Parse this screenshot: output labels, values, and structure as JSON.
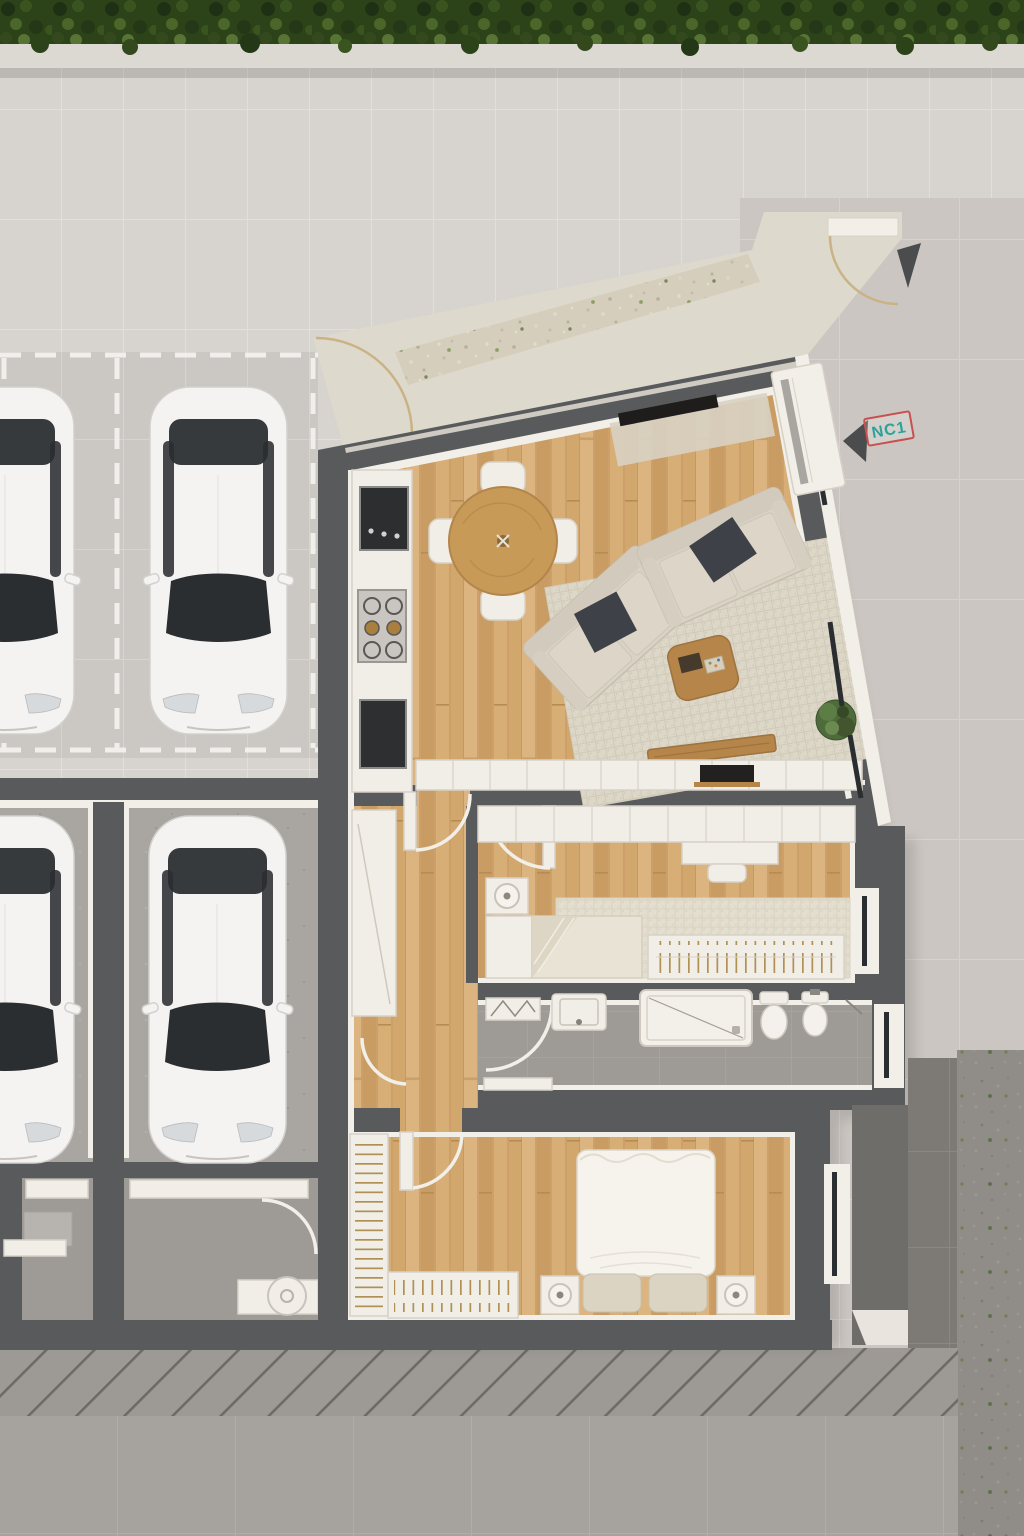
{
  "labels": {
    "unit_badge": "NC1"
  },
  "colors": {
    "wall_dark": "#595a5c",
    "lining_white": "#f2efe9",
    "furniture_white": "#f1eee8",
    "furniture_stroke": "#d8d2c8",
    "glass_dark": "#2b2e31",
    "wood_light": "#dcb480",
    "wood_mid": "#d2a76e",
    "wood_dark": "#c89c62",
    "wood_seam": "#b98f55",
    "pavement_upper": "#d7d3ce",
    "pavement_grout": "#e2dfda",
    "parking_floor": "#cbc7c2",
    "pavement_right": "#cbc6c1",
    "pavement_lower": "#a6a29e",
    "speckled_dark": "#908d88",
    "terrace_cream": "#ded9cd",
    "gravel_beige": "#d5cebc",
    "hedge_green": "#2c4219",
    "planter_grey": "#dcd8d2",
    "concrete_floor": "#a9a5a1",
    "bath_floor": "#9e9b96",
    "rug_beige": "#ddd7c8",
    "rug_light": "#e4decf",
    "sofa_beige": "#d9d2c5",
    "pillow_charcoal": "#3e4248",
    "coffee_wood": "#b5854a",
    "car_body": "#f4f3f1",
    "arrow_dark": "#4b4c4e",
    "nc1_teal": "#2ba39a",
    "nc1_red": "#c85050",
    "gate_gold": "#c9b384",
    "hatch_base": "#9d9995",
    "hatch_line": "#6e6a66",
    "dark_tiles": "#7d7a76",
    "parapet_grey": "#6f6d6a"
  },
  "site": {
    "type": "top-down 3D architectural floor plan render",
    "areas": [
      "hedge planter strip",
      "tiled walkway",
      "open parking spaces",
      "garage boxes",
      "utility rooms",
      "hatched access ramp",
      "apartment NC1",
      "gravel terrace path",
      "side terrace"
    ],
    "parking": {
      "open_spaces": 2,
      "garage_boxes": 2,
      "white_cars_visible": 4,
      "marking_style": "white dashed lines"
    },
    "landscape": {
      "hedge_strip": true,
      "gravel_path": true,
      "gate_swing_arcs": 2,
      "direction_arrows": 2,
      "access_ramp_hatched": true
    }
  },
  "apartment": {
    "unit": "NC1",
    "entrance": "glazed entry door at the top-right corner",
    "windows_right_wall": 3,
    "rooms": [
      {
        "name": "living room + kitchen",
        "floor": "light wood planks",
        "items": [
          "kitchen counter",
          "dark sink module",
          "cooktop with six burners",
          "dark appliance module",
          "round dining table",
          "4 dining chairs",
          "two beige sofas",
          "2 charcoal throw pillows",
          "wooden coffee table",
          "wooden bench",
          "large area rug",
          "tv on console mat",
          "white sideboard",
          "potted plant"
        ]
      },
      {
        "name": "hallway",
        "floor": "light wood planks",
        "items": [
          "tall white cabinet",
          "interior doors with swing arcs"
        ]
      },
      {
        "name": "bedroom",
        "floor": "light wood planks",
        "items": [
          "fitted wardrobe row",
          "desk",
          "chair",
          "single bed with folded blanket",
          "nightstand with round lamp",
          "area rug",
          "open clothes rail with hangers",
          "window"
        ]
      },
      {
        "name": "bathroom",
        "floor": "grey tiles",
        "items": [
          "drying rack",
          "washbasin",
          "walk-in shower tray",
          "toilet",
          "bidet",
          "towel hook",
          "window"
        ]
      },
      {
        "name": "master bedroom",
        "floor": "light wood planks",
        "items": [
          "double bed with white duvet",
          "2 beige pillows",
          "2 nightstands with round lamps",
          "wardrobe with hangers on left wall",
          "open clothes rail with hangers",
          "window"
        ]
      }
    ]
  }
}
